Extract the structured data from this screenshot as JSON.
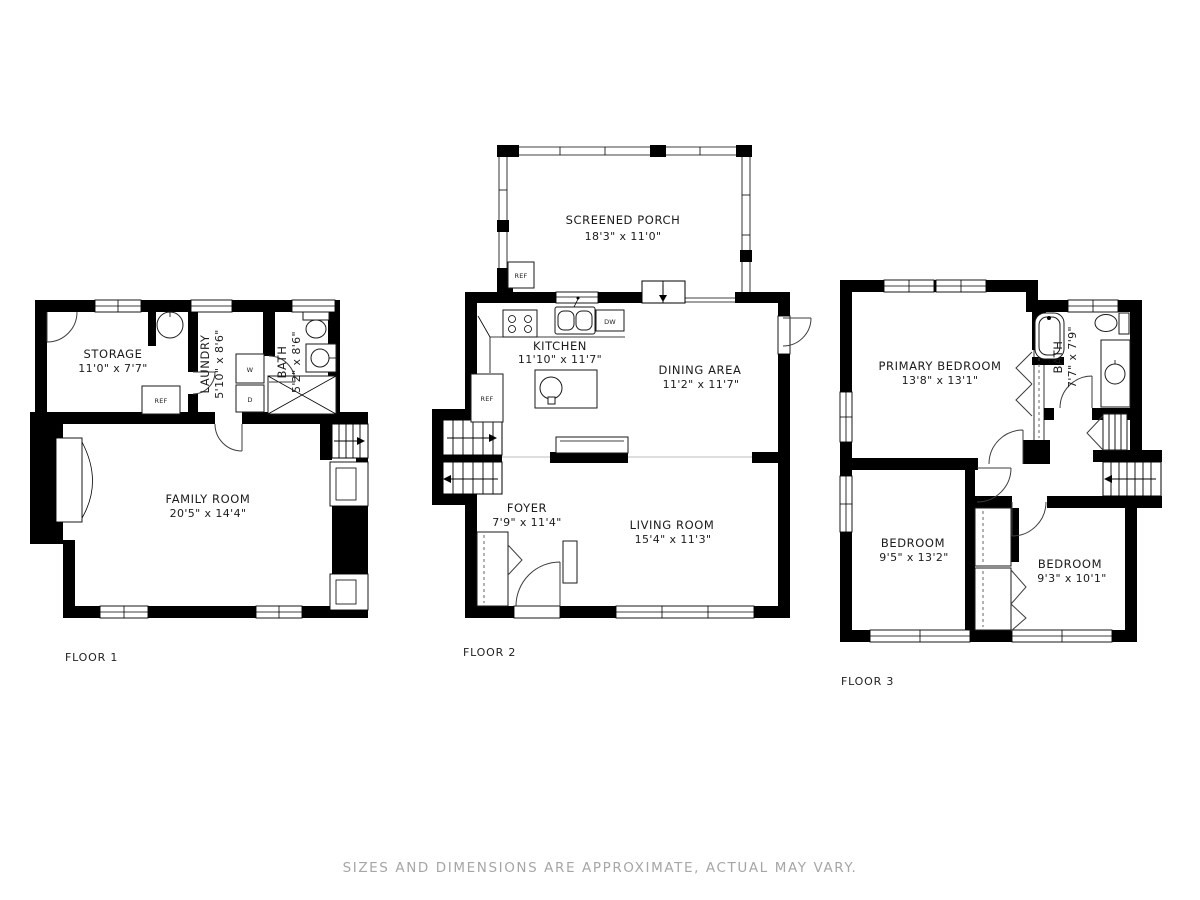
{
  "disclaimer": "SIZES AND DIMENSIONS ARE APPROXIMATE, ACTUAL MAY VARY.",
  "fixtures": {
    "ref": "REF",
    "dw": "DW",
    "washer": "W",
    "dryer": "D"
  },
  "floor1": {
    "label": "FLOOR 1",
    "storage": {
      "name": "STORAGE",
      "dims": "11'0\" x 7'7\""
    },
    "laundry": {
      "name": "LAUNDRY",
      "dims": "5'10\" x 8'6\""
    },
    "bath": {
      "name": "BATH",
      "dims": "5'2\" x 8'6\""
    },
    "family": {
      "name": "FAMILY ROOM",
      "dims": "20'5\" x 14'4\""
    }
  },
  "floor2": {
    "label": "FLOOR 2",
    "porch": {
      "name": "SCREENED PORCH",
      "dims": "18'3\" x 11'0\""
    },
    "kitchen": {
      "name": "KITCHEN",
      "dims": "11'10\" x 11'7\""
    },
    "dining": {
      "name": "DINING AREA",
      "dims": "11'2\" x 11'7\""
    },
    "foyer": {
      "name": "FOYER",
      "dims": "7'9\" x 11'4\""
    },
    "living": {
      "name": "LIVING ROOM",
      "dims": "15'4\" x 11'3\""
    }
  },
  "floor3": {
    "label": "FLOOR 3",
    "primary": {
      "name": "PRIMARY BEDROOM",
      "dims": "13'8\" x 13'1\""
    },
    "bath": {
      "name": "BATH",
      "dims": "7'7\" x 7'9\""
    },
    "bedroom1": {
      "name": "BEDROOM",
      "dims": "9'5\" x 13'2\""
    },
    "bedroom2": {
      "name": "BEDROOM",
      "dims": "9'3\" x 10'1\""
    }
  }
}
